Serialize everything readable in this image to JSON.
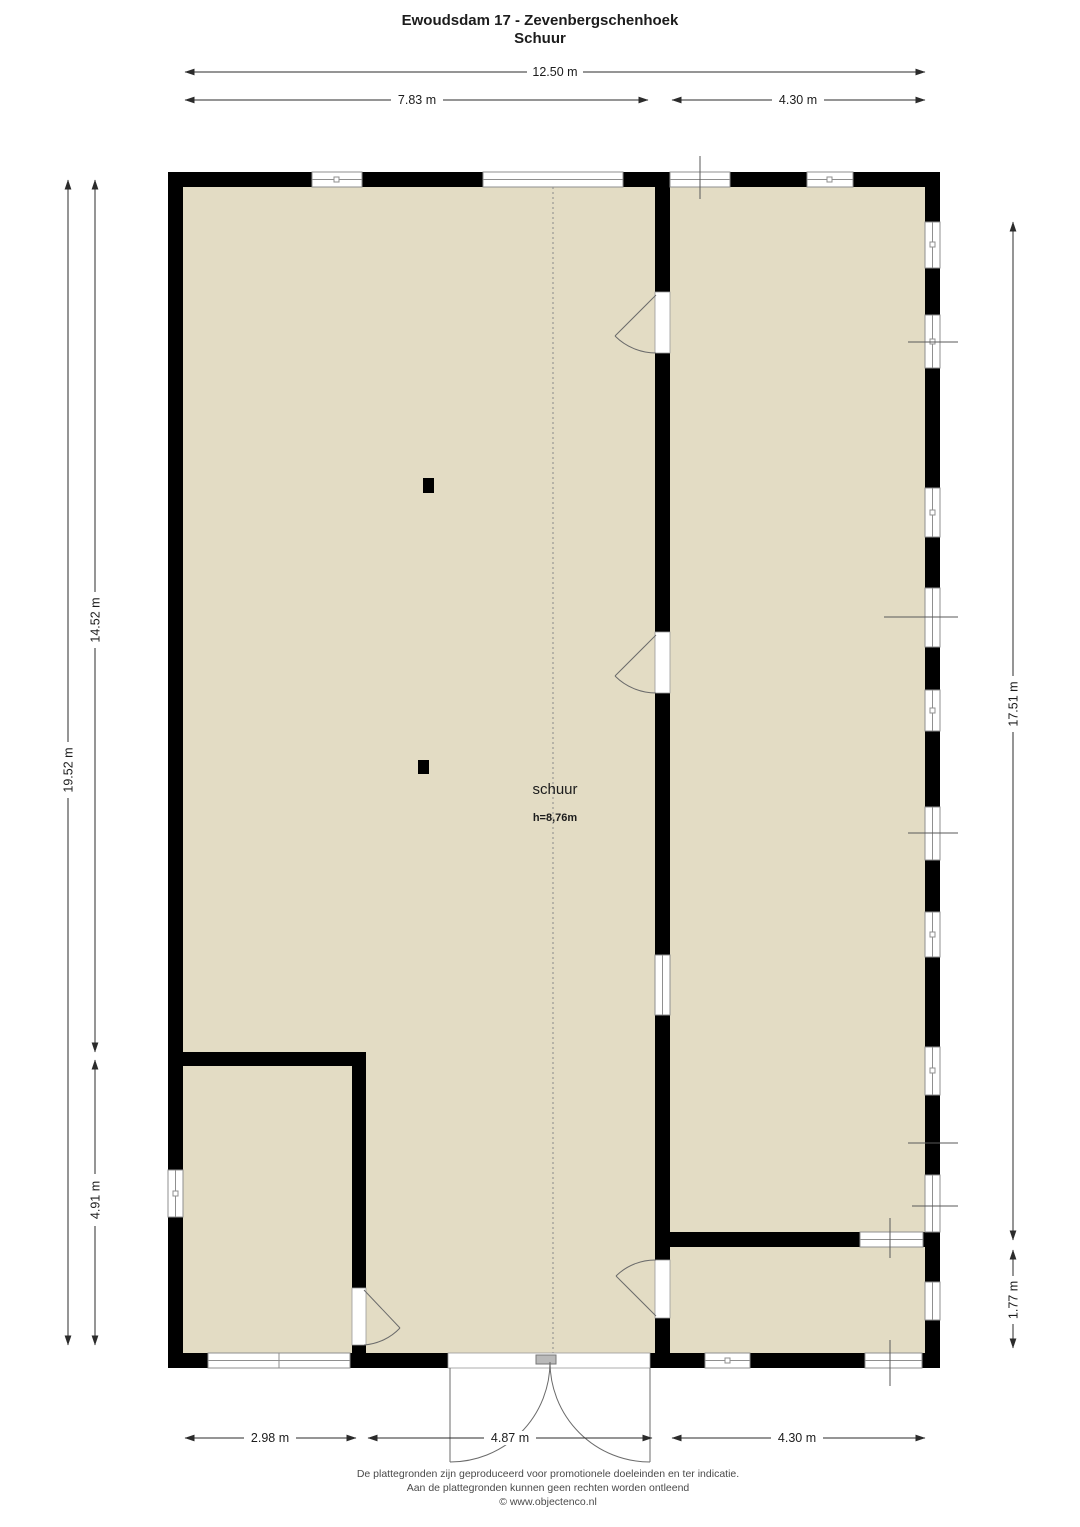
{
  "title": {
    "line1": "Ewoudsdam 17 - Zevenbergschenhoek",
    "line2": "Schuur"
  },
  "room": {
    "name": "schuur",
    "height": "h=8,76m"
  },
  "dimensions": {
    "top_total": "12.50 m",
    "top_left": "7.83 m",
    "top_right": "4.30 m",
    "left_outer": "19.52 m",
    "left_upper": "14.52 m",
    "left_lower": "4.91 m",
    "right_upper": "17.51 m",
    "right_lower": "1.77 m",
    "bottom_left": "2.98 m",
    "bottom_center": "4.87 m",
    "bottom_right": "4.30 m"
  },
  "footer": {
    "line1": "De plattegronden zijn geproduceerd voor promotionele doeleinden en ter indicatie.",
    "line2": "Aan de plattegronden kunnen geen rechten worden ontleend",
    "line3": "© www.objectenco.nl"
  },
  "colors": {
    "floor": "#e3dcc4",
    "wall": "#000000",
    "window_line": "#8f8f8f",
    "dimension": "#2b2b2b",
    "background": "#ffffff"
  }
}
